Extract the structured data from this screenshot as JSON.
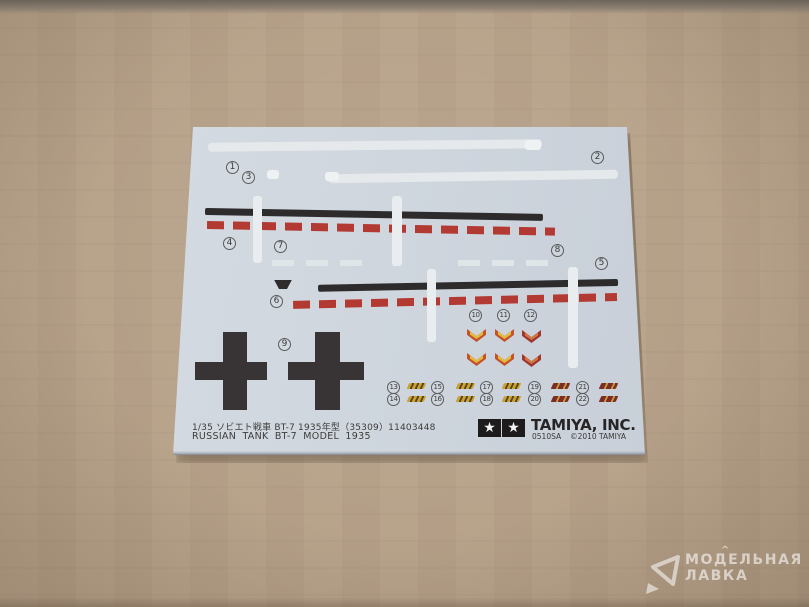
{
  "numbers": [
    "1",
    "2",
    "3",
    "4",
    "5",
    "6",
    "7",
    "8",
    "9",
    "10",
    "11",
    "12",
    "13",
    "14",
    "15",
    "16",
    "17",
    "18",
    "19",
    "20",
    "21",
    "22"
  ],
  "sheet": {
    "caption_line1": "1/35 ソビエト戦車 BT-7 1935年型（35309）11403448",
    "caption_line2": "RUSSIAN TANK BT-7 MODEL 1935",
    "brand": {
      "name": "TAMIYA, INC.",
      "code": "0510SA",
      "copyright": "©2010 TAMIYA",
      "star_icon": "★"
    }
  },
  "watermark": {
    "line1": "МОДЕЛЬНАЯ",
    "line2": "ЛАВКА",
    "accent": "^"
  },
  "colors": {
    "cardboard": "#b7a189",
    "top_band": "#6f675c",
    "sheet_bg": "#cfd6de",
    "stripe_white": "#e5e9ec",
    "stripe_black": "#2e2b2c",
    "stripe_red": "#b23a33",
    "chevron_yellow": "#e5b93e",
    "chevron_orange": "#c2542b",
    "chevron_red": "#a23530",
    "chevron_red_inner": "#cf7742",
    "decal_gold": "#c9a231",
    "decal_dark": "#57431d",
    "decal_maroon": "#7d2d27",
    "cross": "#383435",
    "text": "#3e3c3a",
    "watermark": "rgba(255,255,255,0.58)"
  }
}
